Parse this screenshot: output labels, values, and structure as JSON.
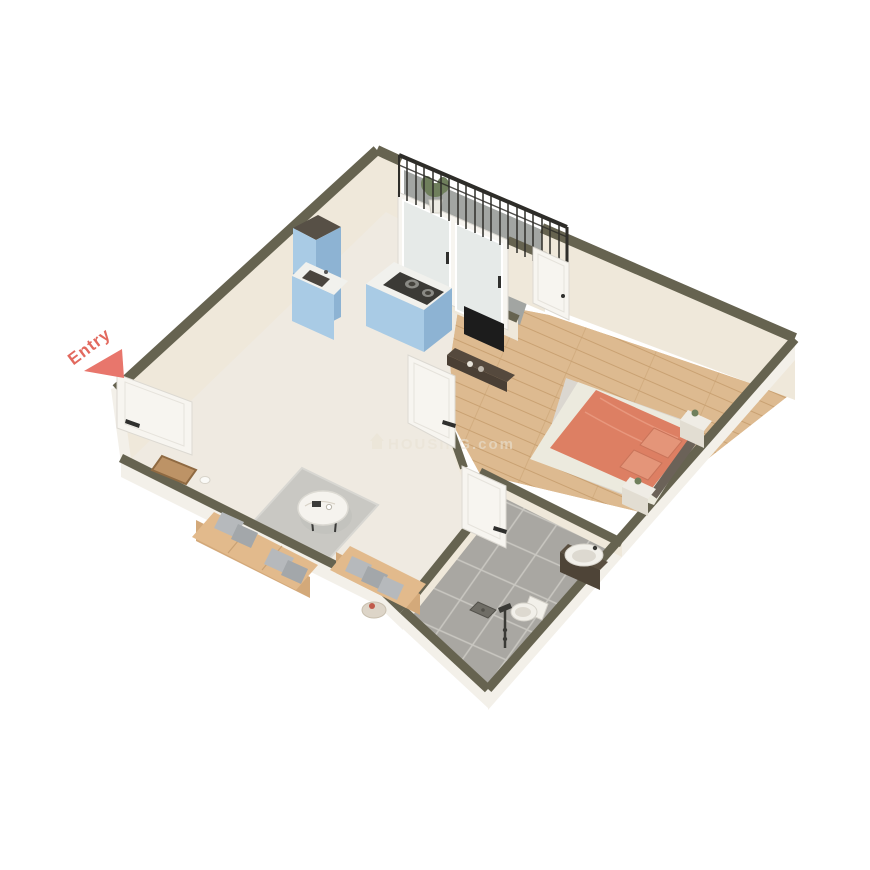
{
  "scene": {
    "type": "isometric-3d-floor-plan-render",
    "description": "3D cutaway render of a 1BHK apartment unit",
    "background": "#ffffff"
  },
  "entry": {
    "label": "Entry"
  },
  "watermark": {
    "text": "HOUSING.com",
    "icon": "house-icon"
  },
  "rooms": [
    {
      "name": "balcony",
      "floor": "concrete-grey",
      "items": [
        "iron-railing",
        "potted-plant",
        "sliding-glass-doors"
      ]
    },
    {
      "name": "kitchen",
      "floor": "marble-white",
      "items": [
        "tall-cabinet",
        "sink-counter",
        "island-with-cooktop"
      ]
    },
    {
      "name": "living-room",
      "floor": "marble-white",
      "items": [
        "sofa-three-seater",
        "sofa-two-seater",
        "round-coffee-table",
        "area-rug",
        "side-table",
        "doormat"
      ]
    },
    {
      "name": "bedroom",
      "floor": "wood-plank",
      "items": [
        "double-bed-coral",
        "nightstand-left",
        "nightstand-right",
        "tv-console",
        "wall-tv",
        "bed-rug"
      ]
    },
    {
      "name": "bathroom",
      "floor": "grey-tile",
      "items": [
        "vanity-washbasin",
        "toilet",
        "shower-set",
        "floor-drain"
      ]
    }
  ],
  "doors": [
    "entry-door",
    "bedroom-door",
    "bathroom-door",
    "balcony-door"
  ],
  "colors": {
    "bg": "#ffffff",
    "wall_top": "#666350",
    "wall_face": "#efe8da",
    "wall_outer": "#f3f0e9",
    "floor_marble": "#efeae1",
    "floor_wood": "#ddba90",
    "wood_seam": "#c9a172",
    "floor_tile": "#a9a7a2",
    "tile_grout": "#c9c7c1",
    "floor_balcony": "#a2a5a2",
    "railing": "#2e2d29",
    "kitchen_cabinet": "#a9cbe5",
    "kitchen_cabinet_dark": "#8db3d3",
    "cabinet_top": "#575046",
    "counter_white": "#f1f1ed",
    "cooktop": "#3b3a36",
    "pan": "#8a8a85",
    "sofa": "#e2ba8c",
    "sofa_dark": "#d3a97a",
    "pillow": "#b6b9bc",
    "pillow_dark": "#a3a7aa",
    "rug_living": "#c9c8c3",
    "rug_bed": "#dbd7d0",
    "table_white": "#f5f3ee",
    "bed": "#dd7f63",
    "bed_light": "#e49579",
    "headboard": "#6b6258",
    "fixture": "#f2f0ea",
    "fixture_shade": "#ddd9d0",
    "vanity": "#4e4437",
    "door": "#f7f5f0",
    "door_edge": "#dcd9d2",
    "handle": "#2f2f2d",
    "dark": "#1c1c1c",
    "plant": "#6f7f5c",
    "mat": "#bd9366",
    "mat_border": "#8f6a42",
    "entry": "#e2695e",
    "entry_arrow": "#e8766c",
    "watermark": "#e9e2d4"
  }
}
